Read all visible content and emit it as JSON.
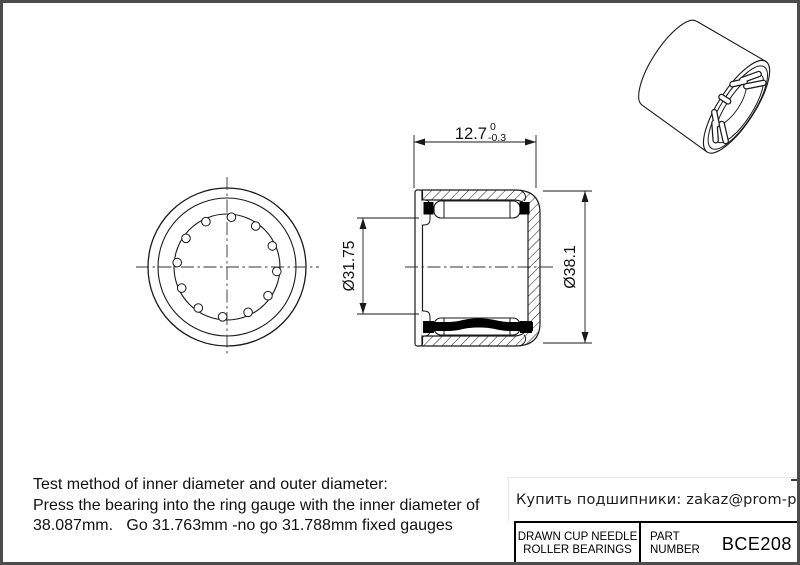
{
  "drawing": {
    "dims": {
      "width": "12.7",
      "width_tol_upper": "0",
      "width_tol_lower": "-0.3",
      "bore_diameter": "Ø31.75",
      "outer_diameter": "Ø38.1"
    },
    "notes": {
      "line1": "Test method of inner diameter and outer diameter:",
      "line2": "Press the bearing into the ring gauge with the inner diameter of",
      "line3": "38.087mm.   Go 31.763mm -no go 31.788mm fixed gauges"
    },
    "contact": "Купить подшипники: zakaz@prom-pod.ru",
    "title_block": {
      "product_type_line1": "DRAWN CUP NEEDLE",
      "product_type_line2": "ROLLER BEARINGS",
      "part_label_line1": "PART",
      "part_label_line2": "NUMBER",
      "part_number": "BCE208"
    },
    "colors": {
      "line": "#1a1a1a",
      "frame": "#4c4c4c",
      "background": "#ffffff"
    }
  }
}
